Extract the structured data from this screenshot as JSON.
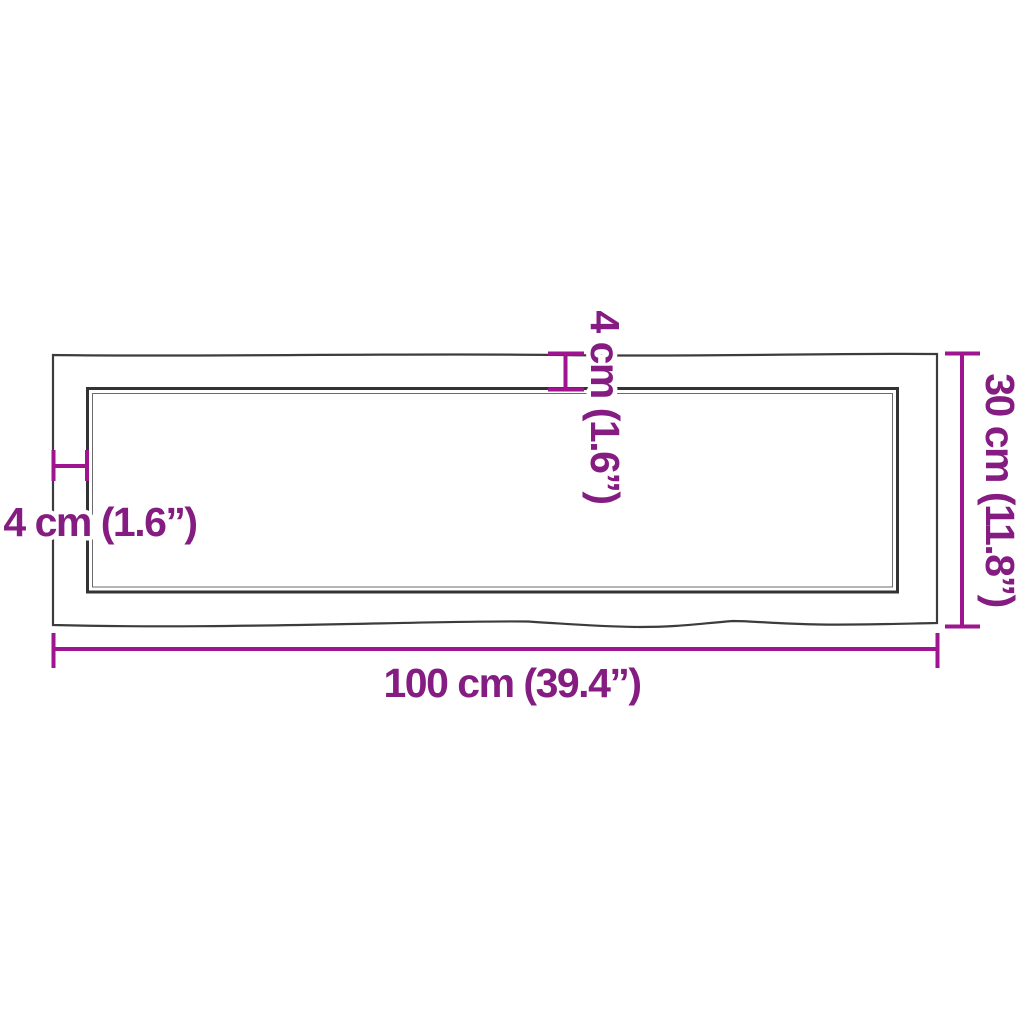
{
  "diagram": {
    "kind": "product-dimension-diagram",
    "subject": "rectangular wood panel (top view) with live wavy edges and inner surface outline",
    "units": [
      "cm",
      "inch"
    ],
    "colors": {
      "background": "#ffffff",
      "panel_outline": "#3c3c3c",
      "dimension_line": "#9e158f",
      "dimension_text": "#851c82",
      "text_halo": "#ffffff"
    },
    "measurements": [
      {
        "id": "width",
        "position": "bottom",
        "cm": 100,
        "inch": 39.4,
        "label": "100 cm (39.4”)"
      },
      {
        "id": "height",
        "position": "right",
        "cm": 30,
        "inch": 11.8,
        "label": "30 cm (11.8”)"
      },
      {
        "id": "edge-thickness-top",
        "position": "top",
        "cm": 4,
        "inch": 1.6,
        "label": "4 cm (1.6”)"
      },
      {
        "id": "edge-thickness-left",
        "position": "left",
        "cm": 4,
        "inch": 1.6,
        "label": "4 cm (1.6”)"
      }
    ]
  }
}
